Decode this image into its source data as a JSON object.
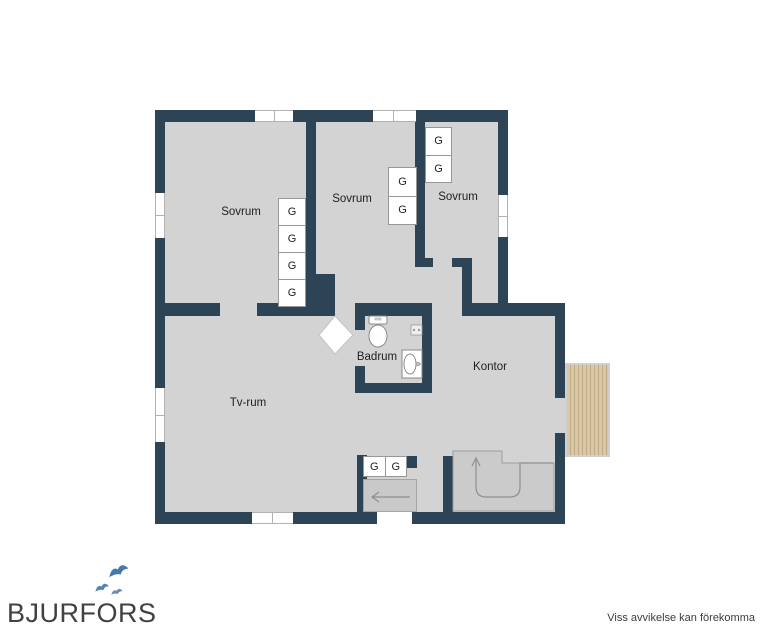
{
  "floor_plan": {
    "rooms": {
      "sovrum_left": "Sovrum",
      "sovrum_middle": "Sovrum",
      "sovrum_right": "Sovrum",
      "badrum": "Badrum",
      "tv_rum": "Tv-rum",
      "kontor": "Kontor"
    },
    "wardrobe_label": "G",
    "colors": {
      "wall": "#2d4456",
      "floor": "#d3d3d3",
      "stair": "#cbcbcb",
      "mat": "#c9c9c9",
      "deck": "#d9c8a6",
      "deckline": "#bfab85"
    }
  },
  "branding": {
    "logo_text": "BJURFORS",
    "bird_color": "#4679a8"
  },
  "footer": {
    "disclaimer": "Viss avvikelse kan förekomma"
  }
}
